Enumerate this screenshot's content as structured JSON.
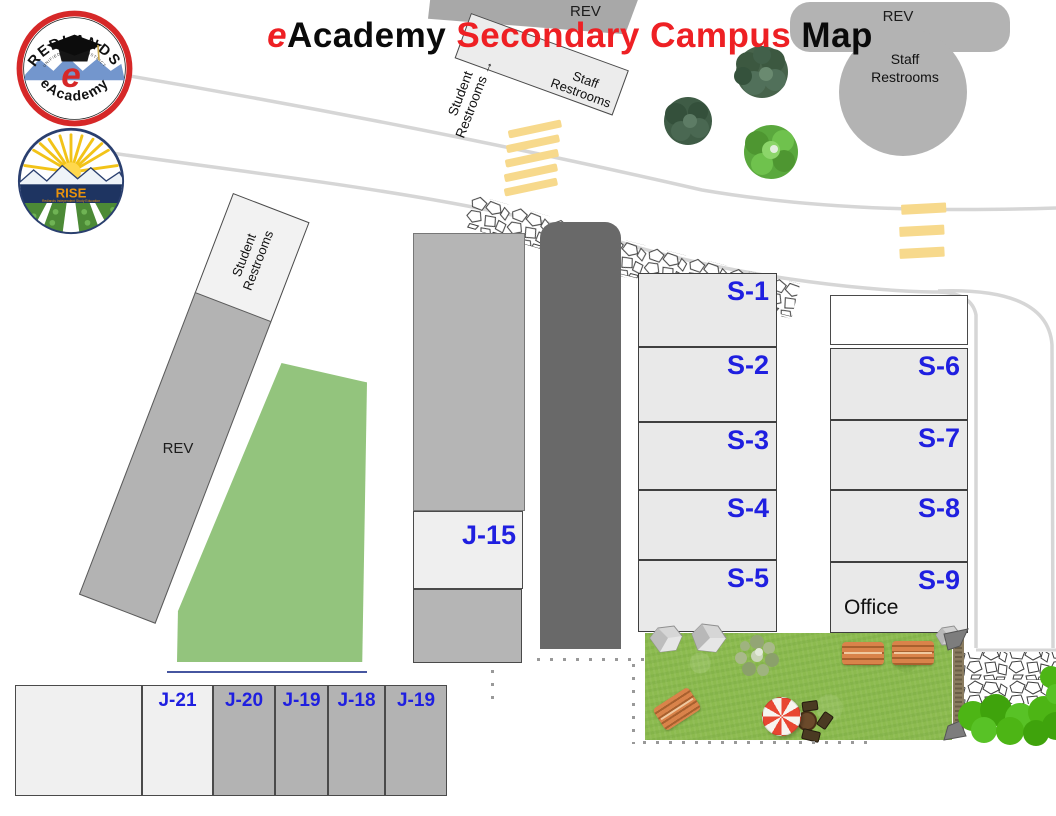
{
  "title": {
    "part1": "e",
    "part2": "Academy",
    "part3": " Secondary Campus ",
    "part4": "Map"
  },
  "logo_eacademy": {
    "arc_top": "REDLANDS",
    "arc_small": "UNIFIED SCHOOL DISTRICT",
    "arc_bottom": "eAcademy",
    "letter": "e"
  },
  "logo_rise": {
    "name": "RISE",
    "subtitle": "Redlands Independent Study Education"
  },
  "map_labels": {
    "rev_center": "REV",
    "rev_right": "REV",
    "rev_left": "REV",
    "staff_center": {
      "line1": "Staff",
      "line2": "Restrooms"
    },
    "staff_right": {
      "line1": "Staff",
      "line2": "Restrooms"
    },
    "student_arrow": {
      "line1": "Student",
      "line2": "Restrooms →"
    },
    "student_left": {
      "line1": "Student",
      "line2": "Restrooms"
    },
    "office": "Office"
  },
  "rooms": {
    "s_left": [
      "S-1",
      "S-2",
      "S-3",
      "S-4",
      "S-5"
    ],
    "s_right": [
      "S-6",
      "S-7",
      "S-8",
      "S-9"
    ],
    "j15": "J-15",
    "j_row": [
      "J-21",
      "J-20",
      "J-19",
      "J-18",
      "J-19"
    ]
  },
  "colors": {
    "title_red": "#ee2024",
    "room_label_blue": "#1f1fe0",
    "room_fill": "#e9e9e9",
    "building_gray": "#b3b3b3",
    "dark_building": "#696969",
    "field_green": "#93c47d",
    "grass_green": "#8cbb4f",
    "road_gray": "#d6d6d6",
    "crosswalk_yellow": "#f7d98c"
  }
}
